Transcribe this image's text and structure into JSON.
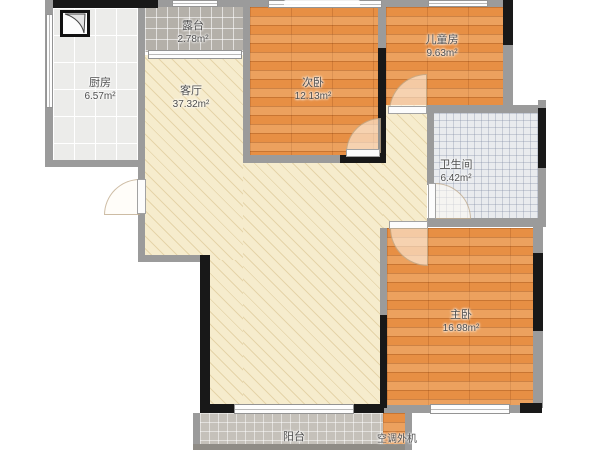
{
  "plan_title": "apartment-floor-plan",
  "colors": {
    "wall": "#9b9b9b",
    "wall_accent": "#181818",
    "wood_floor": "#e78f44",
    "living_floor": "#f6eccd",
    "kitchen_tile": "#ececea",
    "terrace_tile": "#b4b0a9",
    "bath_tile": "#e9ebee",
    "balcony_tile": "#c5c1ba",
    "label_text": "#4f4f4f"
  },
  "rooms": [
    {
      "id": "kitchen",
      "name": "厨房",
      "area": "6.57m²"
    },
    {
      "id": "terrace",
      "name": "露台",
      "area": "2.78m²"
    },
    {
      "id": "living",
      "name": "客厅",
      "area": "37.32m²"
    },
    {
      "id": "bedroom2",
      "name": "次卧",
      "area": "12.13m²"
    },
    {
      "id": "kids-room",
      "name": "儿童房",
      "area": "9.63m²"
    },
    {
      "id": "bathroom",
      "name": "卫生间",
      "area": "6.42m²"
    },
    {
      "id": "master",
      "name": "主卧",
      "area": "16.98m²"
    },
    {
      "id": "balcony",
      "name": "阳台",
      "area": ""
    },
    {
      "id": "ac-platform",
      "name": "空调外机",
      "area": ""
    },
    {
      "id": "top-balcony",
      "name": "",
      "area": "2.58m²"
    }
  ]
}
